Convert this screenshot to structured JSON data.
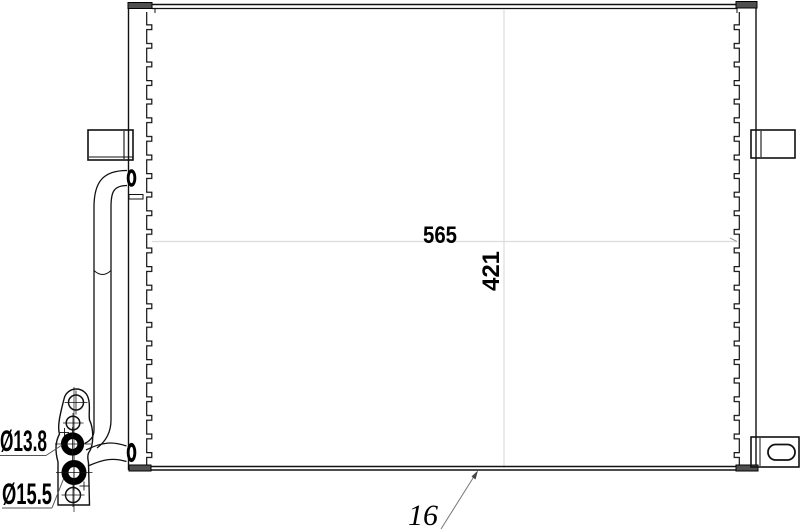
{
  "drawing": {
    "type": "technical-part-drawing",
    "part": "automotive condenser / radiator front view",
    "background_color": "#ffffff",
    "line_color": "#111111",
    "dim_line_color": "#dcdcdc",
    "leader_color": "#555555",
    "labels": {
      "core_width": "565",
      "core_height": "421",
      "core_thickness": "16",
      "port_top_diameter": "Ø13.8",
      "port_bottom_diameter": "Ø15.5"
    }
  }
}
